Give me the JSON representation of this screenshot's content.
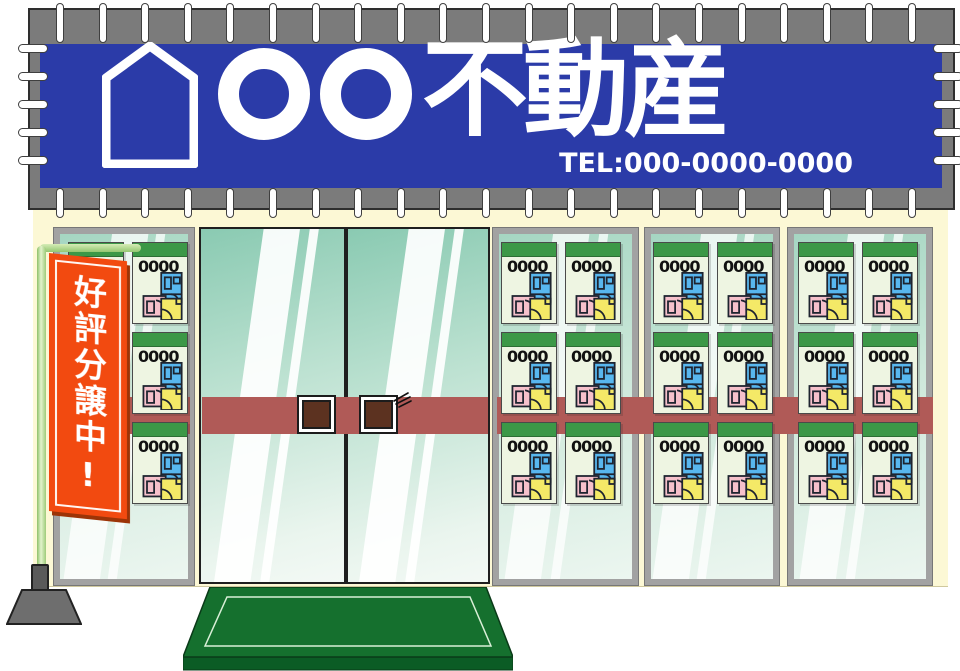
{
  "banner": {
    "title_prefix": "〇〇",
    "title": "不動産",
    "tel": "TEL:000-0000-0000",
    "background_color": "#2b3ba8",
    "frame_color": "#7b7b7b",
    "text_color": "#ffffff"
  },
  "nobori_flag": {
    "text": "好評分譲中!",
    "background_color": "#f24a10",
    "text_color": "#ffffff",
    "pole_color": "#a9d185"
  },
  "storefront": {
    "facade_color": "#fcf8d5",
    "glass_tint_top": "#8acab2",
    "glass_tint_bottom": "#f3f9f5",
    "push_bar_color": "#b05a57",
    "door_handle_color": "#5c3220",
    "entrance_mat_color": "#15702e",
    "flyer_defaults": {
      "header_color": "#3c9847",
      "paper_color": "#eef5e2",
      "room_colors": {
        "blue": "#58b7ef",
        "pink": "#f6c0cb",
        "yellow": "#f4e967"
      }
    },
    "windows": [
      {
        "id": "left-window",
        "flyer_prices": [
          "0000",
          "0000",
          "0000",
          "0000",
          "0000",
          "0000"
        ]
      },
      {
        "id": "right-window-1",
        "flyer_prices": [
          "0000",
          "0000",
          "0000",
          "0000",
          "0000",
          "0000"
        ]
      },
      {
        "id": "right-window-2",
        "flyer_prices": [
          "0000",
          "0000",
          "0000",
          "0000",
          "0000",
          "0000"
        ]
      },
      {
        "id": "right-window-3",
        "flyer_prices": [
          "0000",
          "0000",
          "0000",
          "0000",
          "0000",
          "0000"
        ]
      }
    ]
  }
}
